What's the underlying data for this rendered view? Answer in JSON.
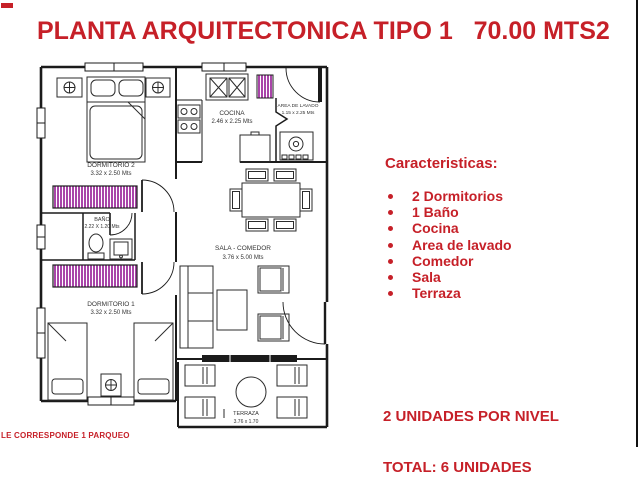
{
  "title": "PLANTA ARQUITECTONICA TIPO 1   70.00 MTS2",
  "colors": {
    "accent_red": "#c62028",
    "closet_magenta": "#a945a9",
    "line_black": "#1b1b1b"
  },
  "plan": {
    "rooms": {
      "dormitorio2": {
        "name": "DORMITORIO 2",
        "dims": "3.32 x 2.50 Mts"
      },
      "bano": {
        "name": "BAÑO",
        "dims": "2.22 X 1.20 Mts"
      },
      "dormitorio1": {
        "name": "DORMITORIO 1",
        "dims": "3.32 x 2.50 Mts"
      },
      "cocina": {
        "name": "COCINA",
        "dims": "2.46 x 2.25 Mts"
      },
      "lavado": {
        "name": "AREA DE LAVADO",
        "dims": "1.15 x 2.25 Mts"
      },
      "sala": {
        "name": "SALA - COMEDOR",
        "dims": "3.76 x 5.00 Mts"
      },
      "terraza": {
        "name": "TERRAZA",
        "dims": "3.76 x 1.70"
      }
    }
  },
  "sidebar": {
    "heading": "Caracteristicas:",
    "items": [
      "2 Dormitorios",
      "1 Baño",
      "Cocina",
      "Area de lavado",
      "Comedor",
      "Sala",
      "Terraza"
    ],
    "units_line1": "2 UNIDADES POR NIVEL",
    "units_line2": "TOTAL: 6 UNIDADES"
  },
  "footer_note": "LE CORRESPONDE 1 PARQUEO"
}
